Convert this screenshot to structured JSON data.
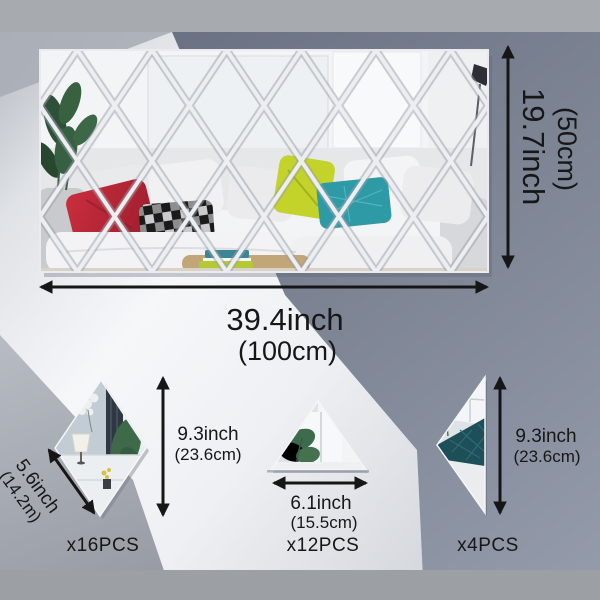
{
  "panel": {
    "height_in": "19.7inch",
    "height_cm": "(50cm)",
    "width_in": "39.4inch",
    "width_cm": "(100cm)"
  },
  "pieces": {
    "rhombus": {
      "diag_in": "5.6inch",
      "diag_cm": "(14.2m)",
      "height_in": "9.3inch",
      "height_cm": "(23.6cm)",
      "count": "x16PCS"
    },
    "triangle": {
      "width_in": "6.1inch",
      "width_cm": "(15.5cm)",
      "count": "x12PCS"
    },
    "half_diamond": {
      "height_in": "9.3inch",
      "height_cm": "(23.6cm)",
      "count": "x4PCS"
    }
  },
  "colors": {
    "arrow_black": "#161616",
    "mirror_seam": "#eceef1",
    "background_dark": "#6f7686",
    "background_light": "#f2f4f6",
    "red_pillow": "#bf2736",
    "chartreuse_pillow": "#c3d32a",
    "teal_pillow": "#2d9aa6"
  }
}
